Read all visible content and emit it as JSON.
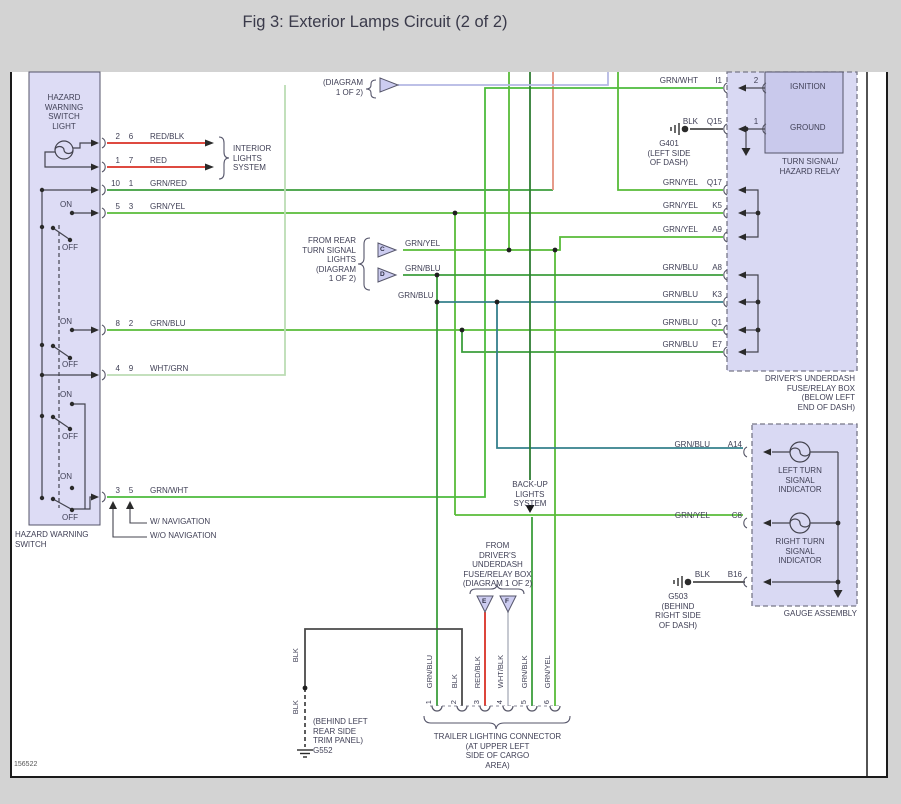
{
  "title": "Fig 3: Exterior Lamps Circuit (2 of 2)",
  "diagram_id": "156522",
  "hazard_switch": {
    "box_label": "HAZARD WARNING\nSWITCH",
    "light_label": "HAZARD\nWARNING\nSWITCH\nLIGHT",
    "on": "ON",
    "off": "OFF",
    "rows": [
      {
        "pin1": "2",
        "pin2": "6",
        "wire": "RED/BLK"
      },
      {
        "pin1": "1",
        "pin2": "7",
        "wire": "RED"
      },
      {
        "pin1": "10",
        "pin2": "1",
        "wire": "GRN/RED"
      },
      {
        "pin1": "5",
        "pin2": "3",
        "wire": "GRN/YEL"
      },
      {
        "pin1": "8",
        "pin2": "2",
        "wire": "GRN/BLU"
      },
      {
        "pin1": "4",
        "pin2": "9",
        "wire": "WHT/GRN"
      },
      {
        "pin1": "3",
        "pin2": "5",
        "wire": "GRN/WHT"
      }
    ],
    "with_nav": "W/ NAVIGATION",
    "without_nav": "W/O NAVIGATION"
  },
  "interior_lights_label": "INTERIOR\nLIGHTS\nSYSTEM",
  "top_ref_label": "(DIAGRAM\n1 OF 2)",
  "rear_turn": {
    "label": "FROM REAR\nTURN SIGNAL\nLIGHTS\n(DIAGRAM\n1 OF 2)",
    "conn_c": "C",
    "conn_d": "D",
    "wire_c": "GRN/YEL",
    "wire_d": "GRN/BLU",
    "wire_d2": "GRN/BLU"
  },
  "backup_label": "BACK-UP\nLIGHTS\nSYSTEM",
  "underdash_src": {
    "label": "FROM\nDRIVER'S\nUNDERDASH\nFUSE/RELAY BOX\n(DIAGRAM 1 OF 2)",
    "conn_e": "E",
    "conn_f": "F"
  },
  "fuse_box": {
    "label": "DRIVER'S UNDERDASH\nFUSE/RELAY BOX\n(BELOW LEFT\nEND OF DASH)",
    "relay_label": "TURN SIGNAL/\nHAZARD RELAY",
    "ignition": "IGNITION",
    "ground": "GROUND",
    "pin_2": "2",
    "pin_1": "1",
    "pins": [
      {
        "id": "I1",
        "wire": "GRN/WHT"
      },
      {
        "id": "Q15",
        "wire": "BLK"
      },
      {
        "id": "Q17",
        "wire": "GRN/YEL"
      },
      {
        "id": "K5",
        "wire": "GRN/YEL"
      },
      {
        "id": "A9",
        "wire": "GRN/YEL"
      },
      {
        "id": "A8",
        "wire": "GRN/BLU"
      },
      {
        "id": "K3",
        "wire": "GRN/BLU"
      },
      {
        "id": "Q1",
        "wire": "GRN/BLU"
      },
      {
        "id": "E7",
        "wire": "GRN/BLU"
      }
    ]
  },
  "g401": {
    "id": "G401",
    "loc": "(LEFT SIDE\nOF DASH)"
  },
  "gauge": {
    "label": "GAUGE ASSEMBLY",
    "left_ind": "LEFT TURN\nSIGNAL\nINDICATOR",
    "right_ind": "RIGHT TURN\nSIGNAL\nINDICATOR",
    "pins": [
      {
        "id": "A14",
        "wire": "GRN/BLU"
      },
      {
        "id": "C8",
        "wire": "GRN/YEL"
      },
      {
        "id": "B16",
        "wire": "BLK"
      }
    ]
  },
  "g503": {
    "id": "G503",
    "loc": "(BEHIND\nRIGHT SIDE\nOF DASH)"
  },
  "g552": {
    "id": "G552",
    "loc": "(BEHIND LEFT\nREAR SIDE\nTRIM PANEL)",
    "wire": "BLK"
  },
  "trailer": {
    "label": "TRAILER LIGHTING CONNECTOR\n(AT UPPER LEFT\nSIDE OF CARGO\nAREA)",
    "pins": [
      {
        "n": "1",
        "wire": "GRN/BLU"
      },
      {
        "n": "2",
        "wire": "BLK"
      },
      {
        "n": "3",
        "wire": "RED/BLK"
      },
      {
        "n": "4",
        "wire": "WHT/BLK"
      },
      {
        "n": "5",
        "wire": "GRN/BLK"
      },
      {
        "n": "6",
        "wire": "GRN/YEL"
      }
    ]
  }
}
